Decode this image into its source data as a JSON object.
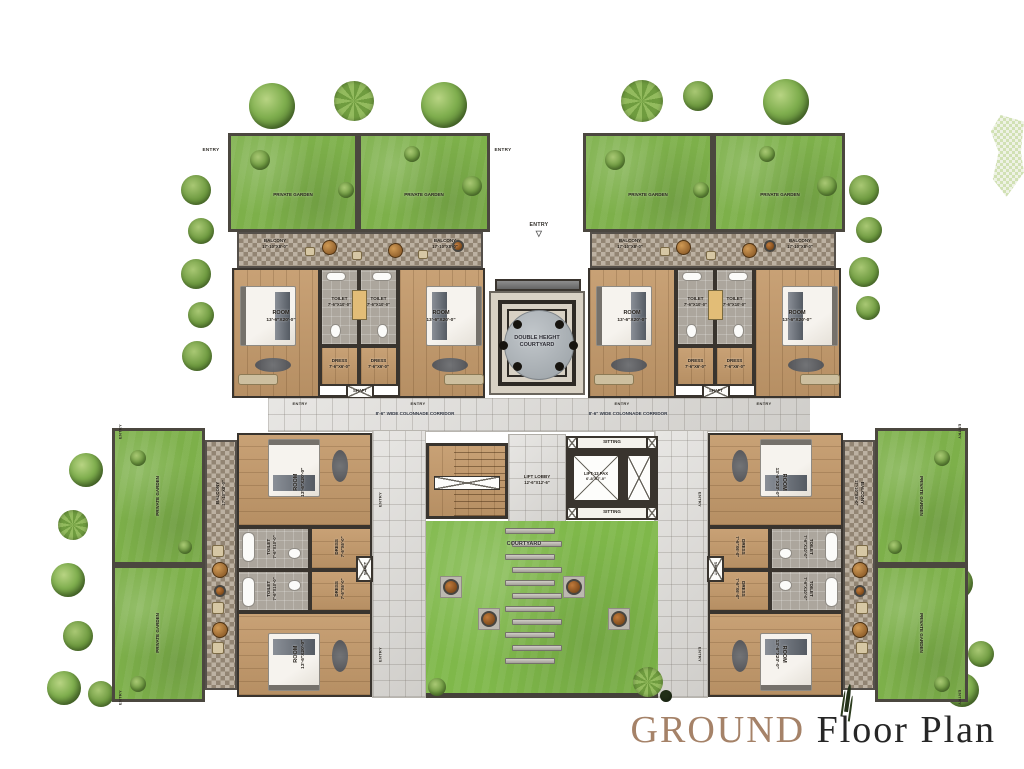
{
  "title": {
    "ground": "GROUND",
    "rest": " Floor Plan"
  },
  "labels": {
    "entry": "ENTRY",
    "entry_arrow": "▽",
    "private_garden": "PRIVATE GARDEN",
    "balcony": "BALCONY",
    "balcony_dim": "17'-10\"X8'-0\"",
    "room": "ROOM",
    "room_dim": "13'-6\"X20'-0\"",
    "toilet": "TOILET",
    "toilet_dim": "7'-6\"X10'-0\"",
    "dress": "DRESS",
    "dress_dim": "7'-6\"X6'-0\"",
    "shaft": "SHAFT",
    "corridor": "8'-6\" WIDE COLONNADE CORRIDOR",
    "dhc_l1": "DOUBLE HEIGHT",
    "dhc_l2": "COURTYARD",
    "lift_lobby": "LIFT LOBBY",
    "lift_lobby_dim": "12'-6\"X12'-6\"",
    "lift": "LIFT-13 PAX",
    "lift_dim": "6'-8\"X7'-0\"",
    "sitting": "SITTING",
    "courtyard": "COURTYARD"
  },
  "colors": {
    "lawn": "#7db04a",
    "wood": "#c49a6b",
    "tile": "#aca69d",
    "wall": "#39342e",
    "corridor": "#dbd9d5",
    "title_accent": "#a58268",
    "title_dark": "#262626"
  }
}
